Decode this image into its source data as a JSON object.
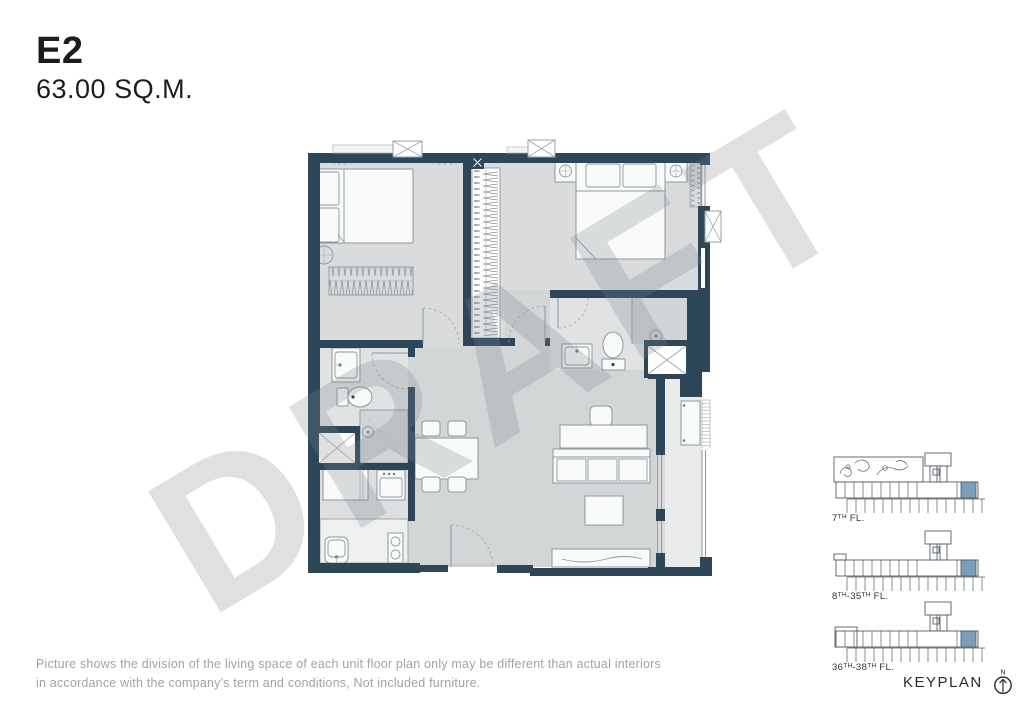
{
  "header": {
    "unit_code": "E2",
    "area": "63.00 SQ.M."
  },
  "watermark": {
    "text": "DRAFT"
  },
  "disclaimer": {
    "line1": "Picture shows the division of the living space of each unit floor plan only may be different than actual interiors",
    "line2": "in accordance with the company's term and conditions, Not included furniture."
  },
  "keyplan": {
    "title": "KEYPLAN",
    "north": "N",
    "floors": [
      {
        "label": "7ᵀᴴ FL."
      },
      {
        "label": "8ᵀᴴ-35ᵀᴴ FL."
      },
      {
        "label": "36ᵀᴴ-38ᵀᴴ FL."
      }
    ]
  },
  "colors": {
    "wall": "#2d4759",
    "accent": "#7d9db6",
    "floorBase": "#d9dbdc",
    "floorOpen": "#d3d6d7",
    "floorBath": "#e0e2e3",
    "floorShower": "#d1d5d7",
    "floorKitchen": "#dcdee0",
    "balcony": "#eaecec",
    "counter": "#eef0f0",
    "furn": "#f9fafa",
    "fs": "#8f979c",
    "hatch": "#868e94",
    "watermark": "rgba(125,130,134,0.25)",
    "title": "#1c1c1e",
    "muted": "#a3a3a3",
    "keyline": "#565d63"
  }
}
